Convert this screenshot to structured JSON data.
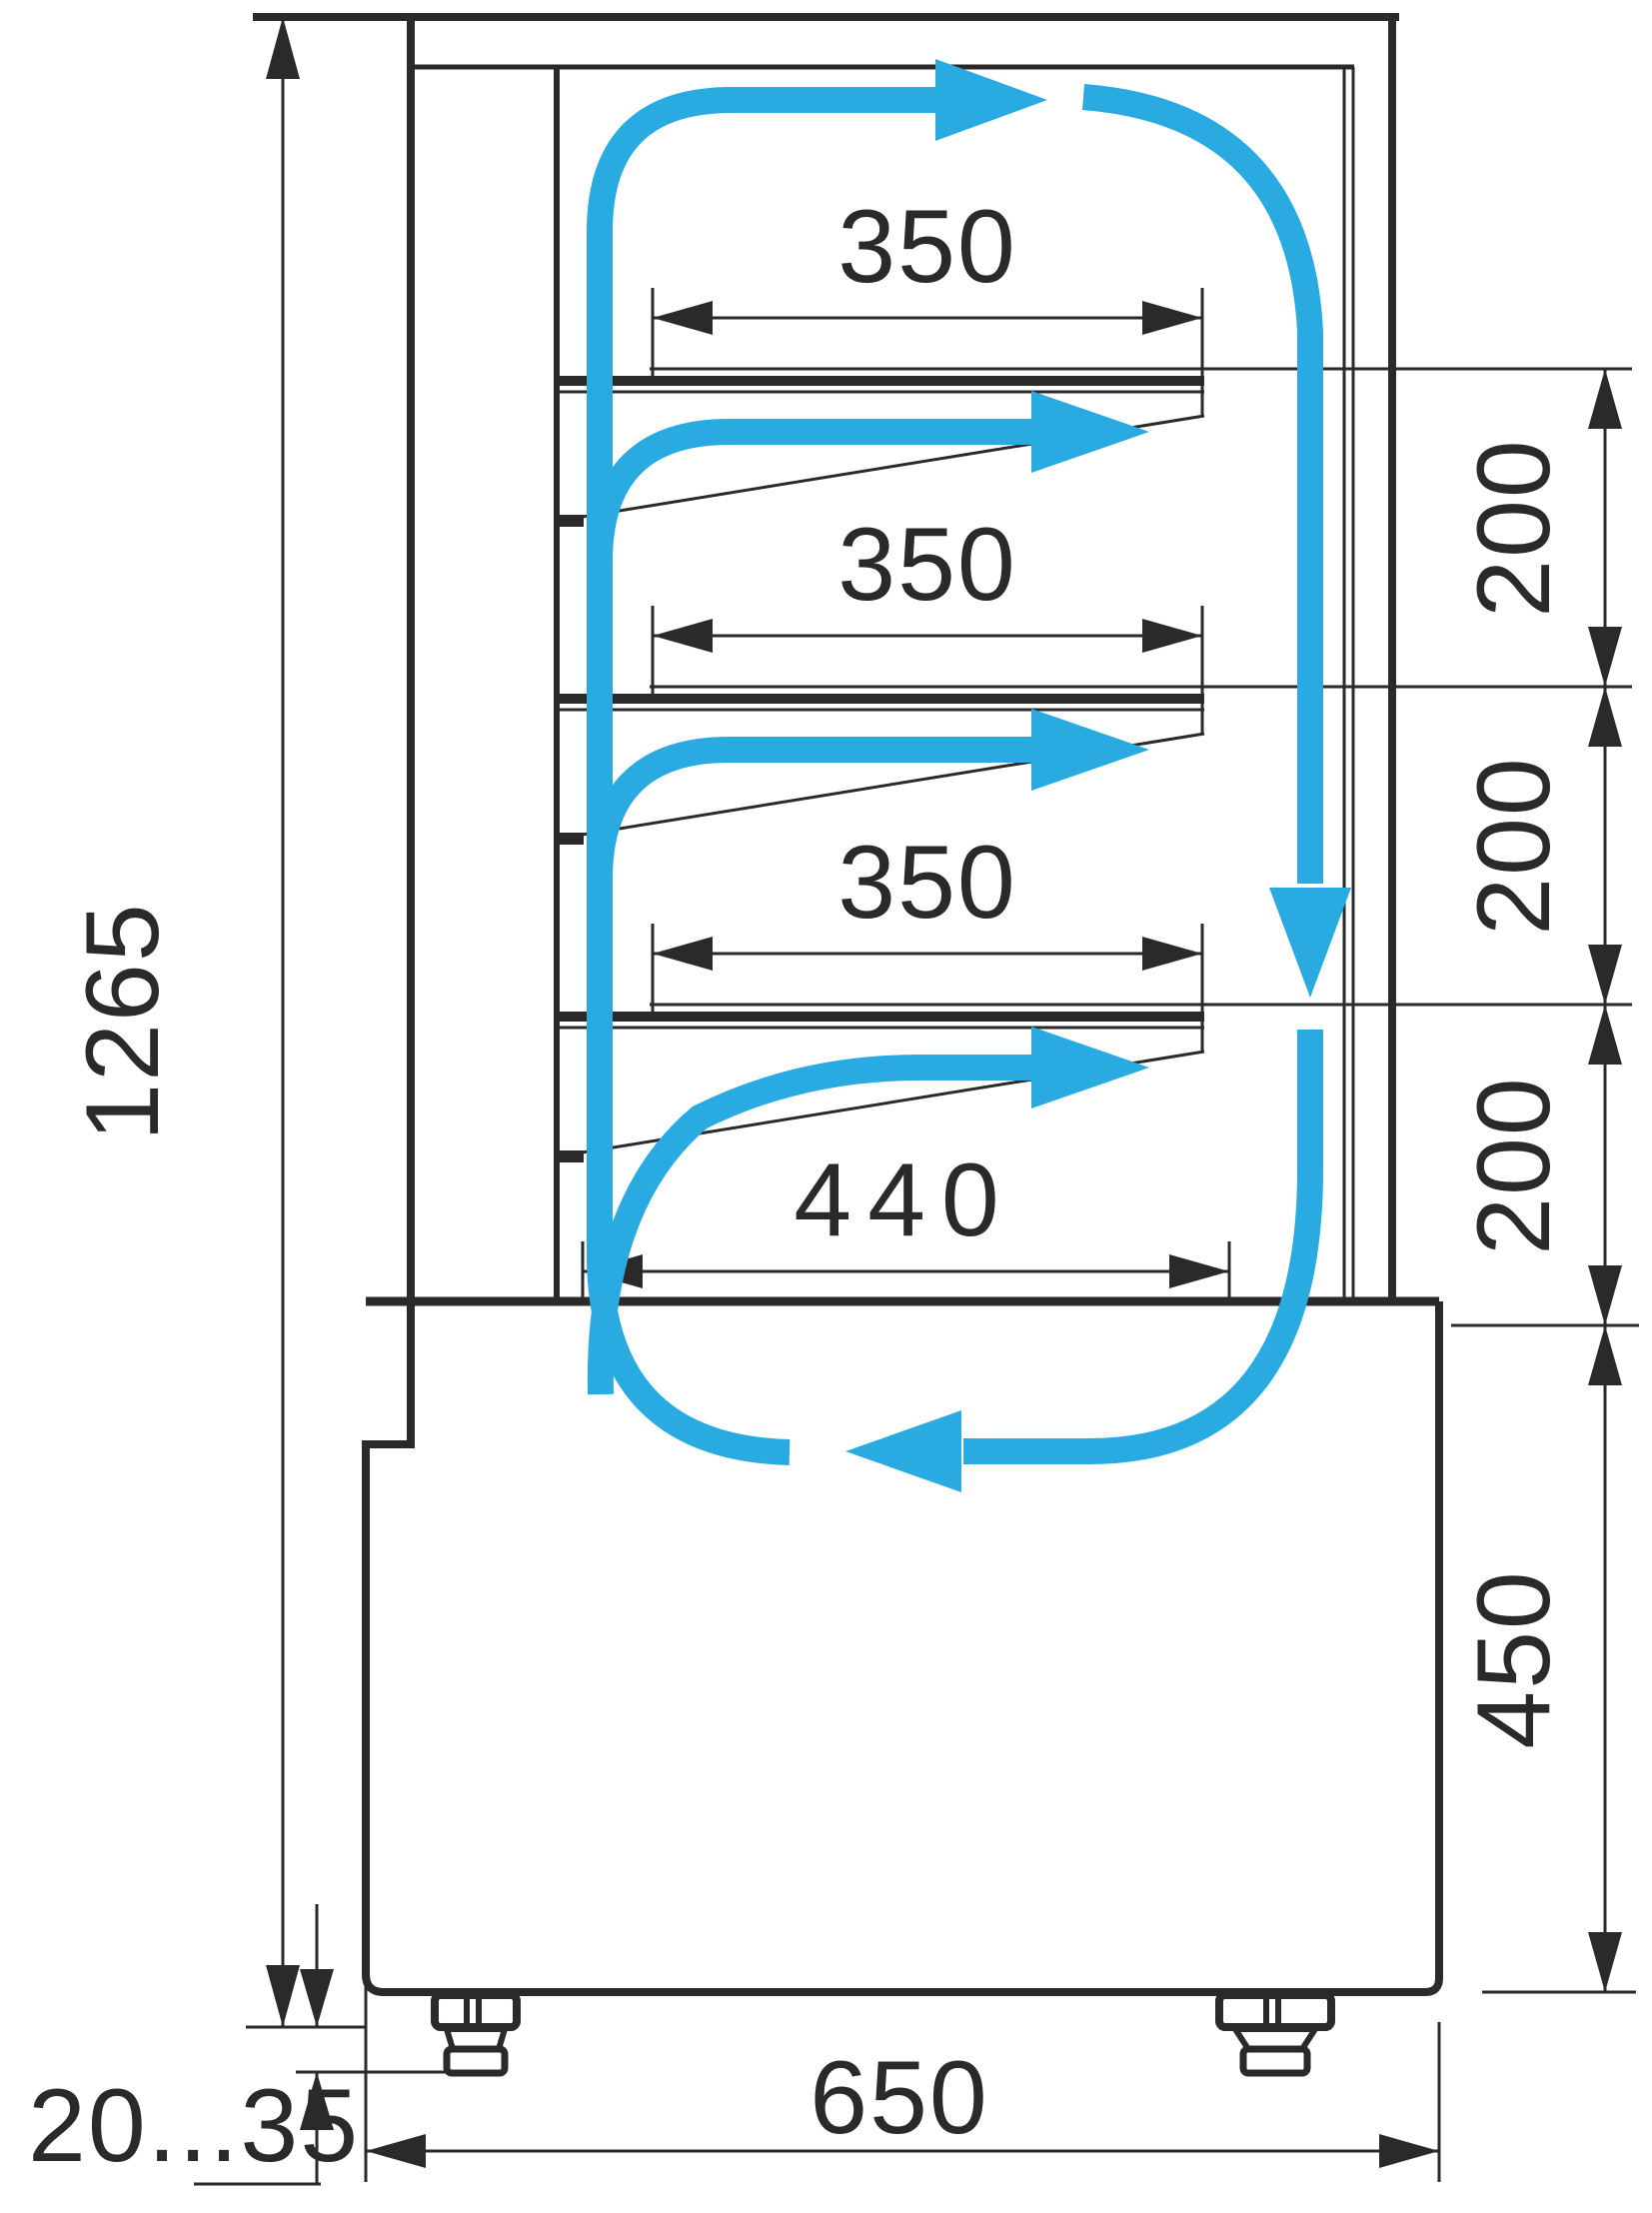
{
  "diagram": {
    "type": "technical-drawing",
    "subject": "Refrigerated display case side section with shelf dimensions and air circulation",
    "units": "mm",
    "labels": {
      "overall_height": "1265",
      "shelf_depths": [
        "350",
        "350",
        "350"
      ],
      "bottom_shelf_depth": "440",
      "shelf_gaps": [
        "200",
        "200",
        "200"
      ],
      "base_height": "450",
      "base_depth": "650",
      "foot_height_range": "20...35"
    },
    "colors": {
      "line": "#2b2a29",
      "airflow": "#29abe2",
      "background": "#ffffff"
    }
  }
}
